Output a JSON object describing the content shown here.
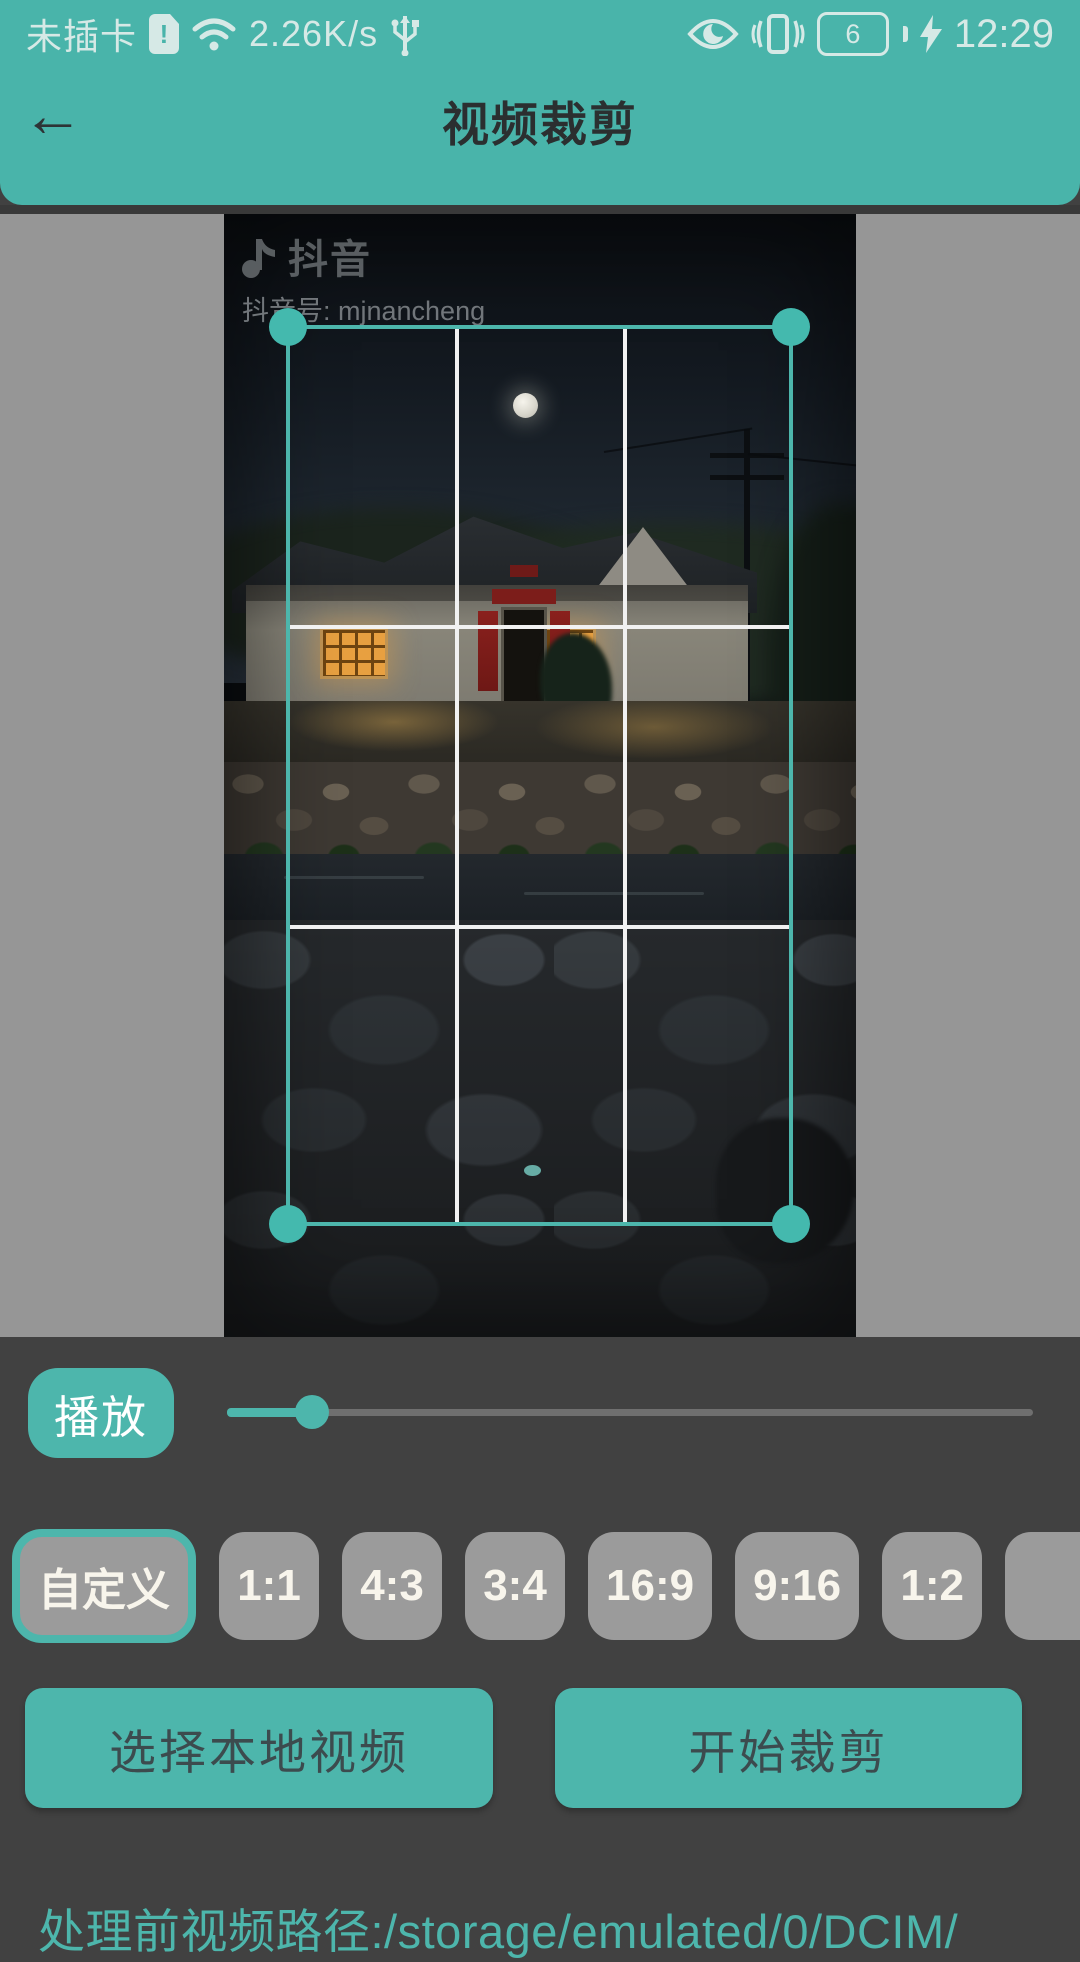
{
  "status_bar": {
    "carrier": "未插卡",
    "sim_alert": "!",
    "network_speed": "2.26K/s",
    "battery_level": "6",
    "time": "12:29"
  },
  "header": {
    "title": "视频裁剪",
    "back_glyph": "←"
  },
  "video": {
    "watermark_brand": "抖音",
    "watermark_account": "抖音号: mjnancheng"
  },
  "playback": {
    "play_label": "播放",
    "slider_percent": 10
  },
  "aspect_ratios": [
    {
      "label": "自定义",
      "selected": true
    },
    {
      "label": "1:1",
      "selected": false
    },
    {
      "label": "4:3",
      "selected": false
    },
    {
      "label": "3:4",
      "selected": false
    },
    {
      "label": "16:9",
      "selected": false
    },
    {
      "label": "9:16",
      "selected": false
    },
    {
      "label": "1:2",
      "selected": false
    },
    {
      "label": "",
      "selected": false
    }
  ],
  "actions": {
    "select_local_video": "选择本地视频",
    "start_crop": "开始裁剪"
  },
  "footer": {
    "path_text": "处理前视频路径:/storage/emulated/0/DCIM/"
  },
  "icons": {
    "status_left": [
      "sim-alert-icon",
      "wifi-icon",
      "usb-icon"
    ],
    "status_right": [
      "eye-icon",
      "vibrate-icon",
      "battery-icon",
      "charging-bolt-icon"
    ],
    "watermark": "music-note-icon",
    "nav": "back-arrow-icon"
  },
  "colors": {
    "accent_teal": "#4db6ac",
    "header_bg": "#49b4aa",
    "panel_bg": "#414141",
    "main_bg": "#969696",
    "ratio_btn_bg": "#9b9b9b",
    "grid_line": "#f1f1f1"
  }
}
